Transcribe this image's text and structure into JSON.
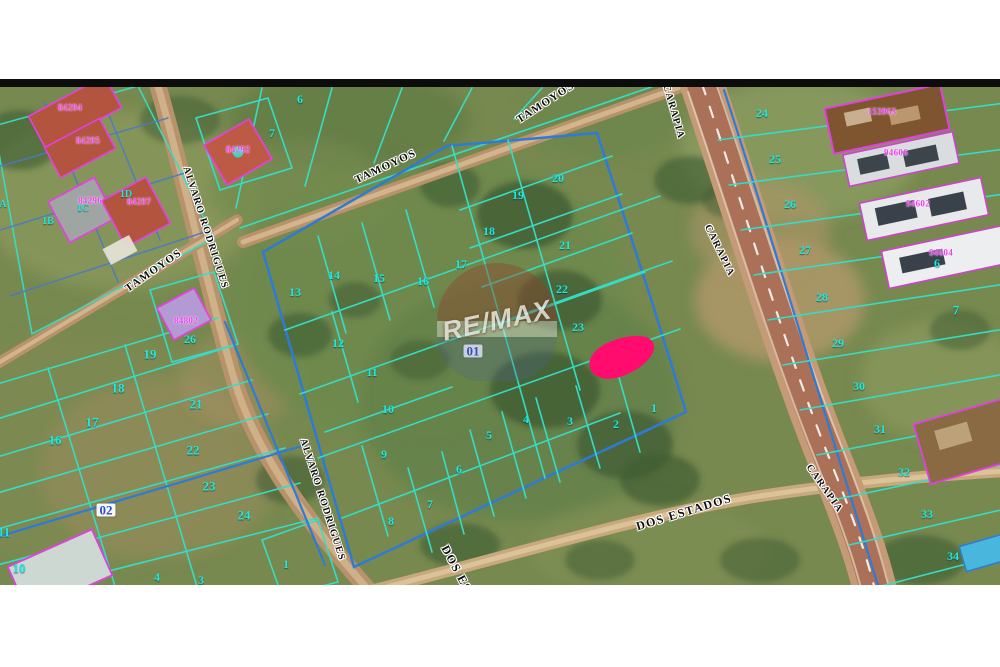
{
  "map": {
    "watermark": {
      "text": "RE/MAX"
    },
    "colors": {
      "highlight_pink": "#ff0c6e",
      "parcel_teal": "#35dcc6",
      "parcel_blue": "#2e7bd6",
      "lot_number_cyan": "#1fe9df",
      "building_label_magenta": "#f03cf0",
      "block_label_blue": "#2f49d0",
      "road_dirt_tan": "#b8926b",
      "grass_green": "#77894f"
    },
    "block_labels": [
      {
        "t": "01",
        "x": 473,
        "y": 351
      },
      {
        "t": "02",
        "x": 106,
        "y": 510
      }
    ],
    "lot_numbers": [
      {
        "t": "6",
        "x": 300,
        "y": 99
      },
      {
        "t": "7",
        "x": 272,
        "y": 133
      },
      {
        "t": "13",
        "x": 295,
        "y": 292
      },
      {
        "t": "14",
        "x": 334,
        "y": 275
      },
      {
        "t": "15",
        "x": 379,
        "y": 278
      },
      {
        "t": "16",
        "x": 423,
        "y": 281
      },
      {
        "t": "17",
        "x": 461,
        "y": 264
      },
      {
        "t": "18",
        "x": 489,
        "y": 231
      },
      {
        "t": "19",
        "x": 518,
        "y": 195
      },
      {
        "t": "20",
        "x": 558,
        "y": 178
      },
      {
        "t": "21",
        "x": 565,
        "y": 245
      },
      {
        "t": "22",
        "x": 562,
        "y": 289
      },
      {
        "t": "23",
        "x": 578,
        "y": 327
      },
      {
        "t": "12",
        "x": 338,
        "y": 343
      },
      {
        "t": "11",
        "x": 372,
        "y": 372
      },
      {
        "t": "10",
        "x": 388,
        "y": 409
      },
      {
        "t": "9",
        "x": 384,
        "y": 454
      },
      {
        "t": "8",
        "x": 391,
        "y": 521
      },
      {
        "t": "7",
        "x": 430,
        "y": 504
      },
      {
        "t": "6",
        "x": 459,
        "y": 469
      },
      {
        "t": "5",
        "x": 489,
        "y": 435
      },
      {
        "t": "4",
        "x": 526,
        "y": 419
      },
      {
        "t": "3",
        "x": 570,
        "y": 421
      },
      {
        "t": "2",
        "x": 616,
        "y": 424
      },
      {
        "t": "1",
        "x": 654,
        "y": 408
      },
      {
        "t": "26",
        "x": 190,
        "y": 339
      },
      {
        "t": "19",
        "x": 150,
        "y": 354,
        "s": 13
      },
      {
        "t": "18",
        "x": 118,
        "y": 388,
        "s": 13
      },
      {
        "t": "21",
        "x": 196,
        "y": 404,
        "s": 13
      },
      {
        "t": "17",
        "x": 92,
        "y": 422,
        "s": 13
      },
      {
        "t": "16",
        "x": 55,
        "y": 440,
        "s": 13
      },
      {
        "t": "22",
        "x": 193,
        "y": 450,
        "s": 13
      },
      {
        "t": "23",
        "x": 209,
        "y": 486,
        "s": 13
      },
      {
        "t": "24",
        "x": 244,
        "y": 515,
        "s": 13
      },
      {
        "t": "11",
        "x": 4,
        "y": 532,
        "s": 13
      },
      {
        "t": "10",
        "x": 19,
        "y": 568,
        "s": 13
      },
      {
        "t": "4",
        "x": 157,
        "y": 577
      },
      {
        "t": "3",
        "x": 201,
        "y": 580
      },
      {
        "t": "1",
        "x": 286,
        "y": 564
      },
      {
        "t": "24",
        "x": 762,
        "y": 113
      },
      {
        "t": "25",
        "x": 775,
        "y": 159
      },
      {
        "t": "26",
        "x": 790,
        "y": 204
      },
      {
        "t": "27",
        "x": 805,
        "y": 250
      },
      {
        "t": "28",
        "x": 822,
        "y": 297
      },
      {
        "t": "29",
        "x": 838,
        "y": 343
      },
      {
        "t": "30",
        "x": 859,
        "y": 386
      },
      {
        "t": "31",
        "x": 880,
        "y": 429
      },
      {
        "t": "32",
        "x": 904,
        "y": 472
      },
      {
        "t": "33",
        "x": 927,
        "y": 514
      },
      {
        "t": "34",
        "x": 953,
        "y": 556
      },
      {
        "t": "7",
        "x": 956,
        "y": 310,
        "s": 13
      },
      {
        "t": "6",
        "x": 937,
        "y": 263
      }
    ],
    "unit_labels": [
      {
        "t": "A",
        "x": 3,
        "y": 205
      },
      {
        "t": "1B",
        "x": 48,
        "y": 222
      },
      {
        "t": "1C",
        "x": 83,
        "y": 209
      },
      {
        "t": "1D",
        "x": 126,
        "y": 195
      }
    ],
    "building_labels": [
      {
        "t": "84294",
        "x": 70,
        "y": 108
      },
      {
        "t": "84295",
        "x": 88,
        "y": 141
      },
      {
        "t": "84296",
        "x": 90,
        "y": 201
      },
      {
        "t": "84297",
        "x": 139,
        "y": 202
      },
      {
        "t": "84292",
        "x": 238,
        "y": 150
      },
      {
        "t": "84802",
        "x": 186,
        "y": 321
      },
      {
        "t": "153963",
        "x": 882,
        "y": 112
      },
      {
        "t": "94606",
        "x": 896,
        "y": 153
      },
      {
        "t": "94602",
        "x": 918,
        "y": 204
      },
      {
        "t": "94604",
        "x": 941,
        "y": 253
      }
    ],
    "street_labels": [
      {
        "t": "TAMOYOS",
        "x": 386,
        "y": 167,
        "r": -25
      },
      {
        "t": "TAMOYOS",
        "x": 546,
        "y": 103,
        "r": -33
      },
      {
        "t": "TAMOYOS",
        "x": 154,
        "y": 271,
        "r": -35
      },
      {
        "t": "ALVARO RODRIGUES",
        "x": 205,
        "y": 228,
        "r": 72,
        "s": 10
      },
      {
        "t": "ALVARO RODRIGUES",
        "x": 322,
        "y": 500,
        "r": 72,
        "s": 10
      },
      {
        "t": "CARAPIA",
        "x": 673,
        "y": 112,
        "r": 74,
        "s": 10
      },
      {
        "t": "CARAPIA",
        "x": 719,
        "y": 251,
        "r": 64,
        "s": 10
      },
      {
        "t": "CARAPIA",
        "x": 824,
        "y": 489,
        "r": 55,
        "s": 10
      },
      {
        "t": "DOS ESTADOS",
        "x": 684,
        "y": 512,
        "r": -17,
        "s": 12
      },
      {
        "t": "DOS ESTADOS",
        "x": 468,
        "y": 590,
        "r": 62,
        "s": 12
      }
    ]
  }
}
